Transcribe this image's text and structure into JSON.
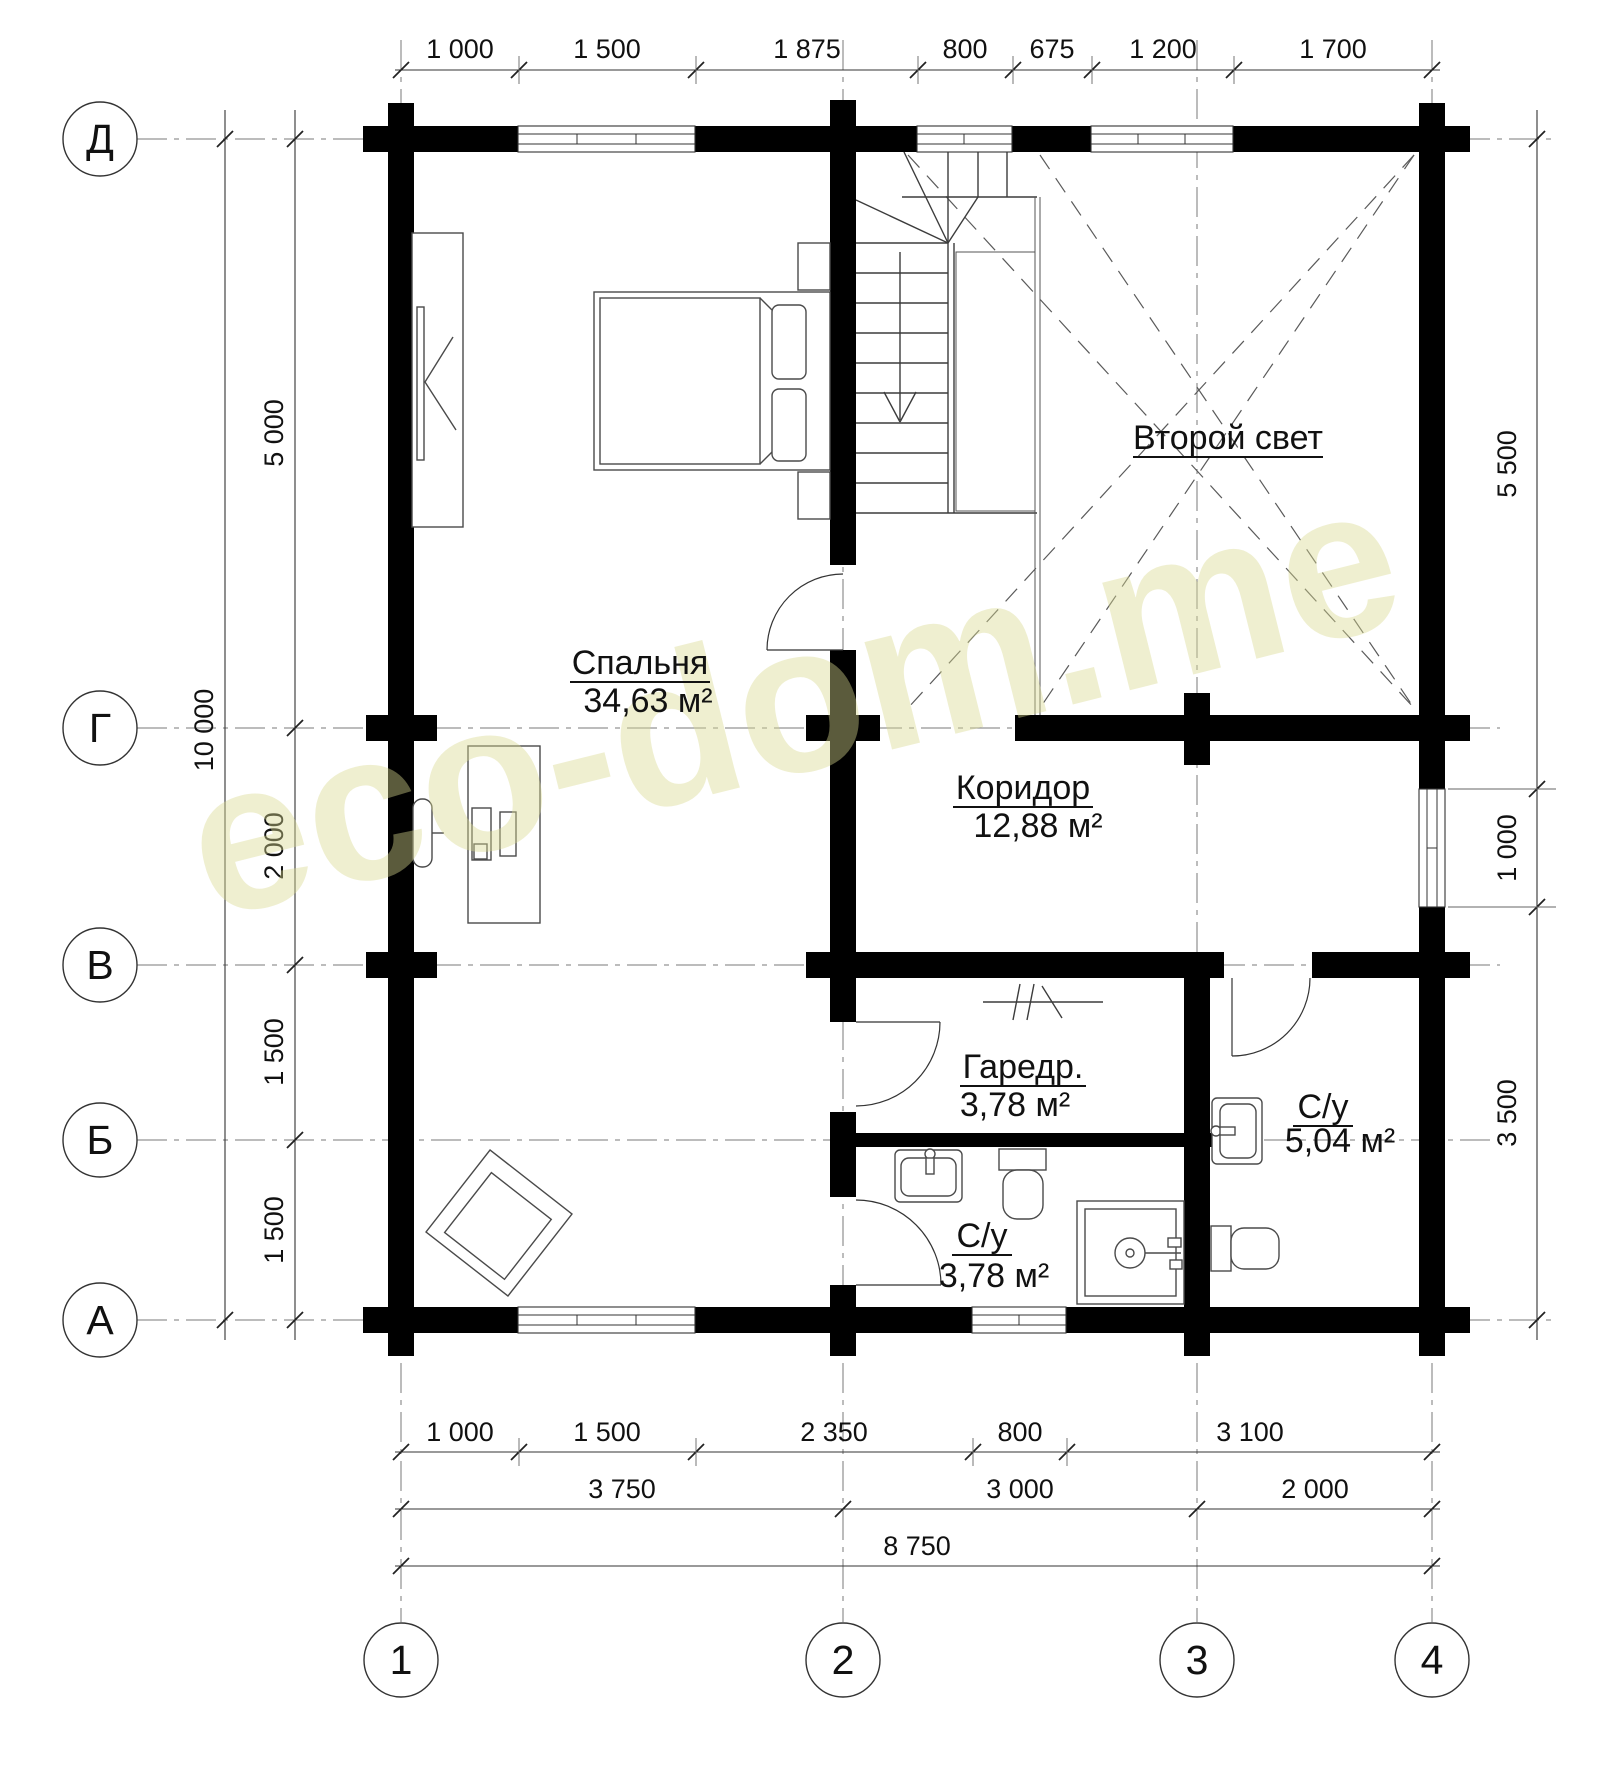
{
  "watermark": {
    "text": "eco-dom.me",
    "color": "#d8d890"
  },
  "axes": {
    "rows": [
      "Д",
      "Г",
      "В",
      "Б",
      "А"
    ],
    "cols": [
      "1",
      "2",
      "3",
      "4"
    ]
  },
  "rooms": {
    "bedroom": {
      "name": "Спальня",
      "area": "34,63 м²"
    },
    "second_light": {
      "name": "Второй свет"
    },
    "corridor": {
      "name": "Коридор",
      "area": "12,88 м²"
    },
    "wardrobe": {
      "name": "Гаредр.",
      "area": "3,78 м²"
    },
    "bath_small": {
      "name": "С/у",
      "area": "3,78 м²"
    },
    "bath_big": {
      "name": "С/у",
      "area": "5,04 м²"
    }
  },
  "dimensions": {
    "top": [
      "1 000",
      "1 500",
      "1 875",
      "800",
      "675",
      "1 200",
      "1 700"
    ],
    "bottom_row1": [
      "1 000",
      "1 500",
      "2 350",
      "800",
      "3 100"
    ],
    "bottom_row2": [
      "3 750",
      "3 000",
      "2 000"
    ],
    "bottom_total": "8 750",
    "left": [
      "5 000",
      "2 000",
      "1 500",
      "1 500"
    ],
    "left_total": "10 000",
    "right": [
      "5 500",
      "1 000",
      "3 500"
    ]
  }
}
